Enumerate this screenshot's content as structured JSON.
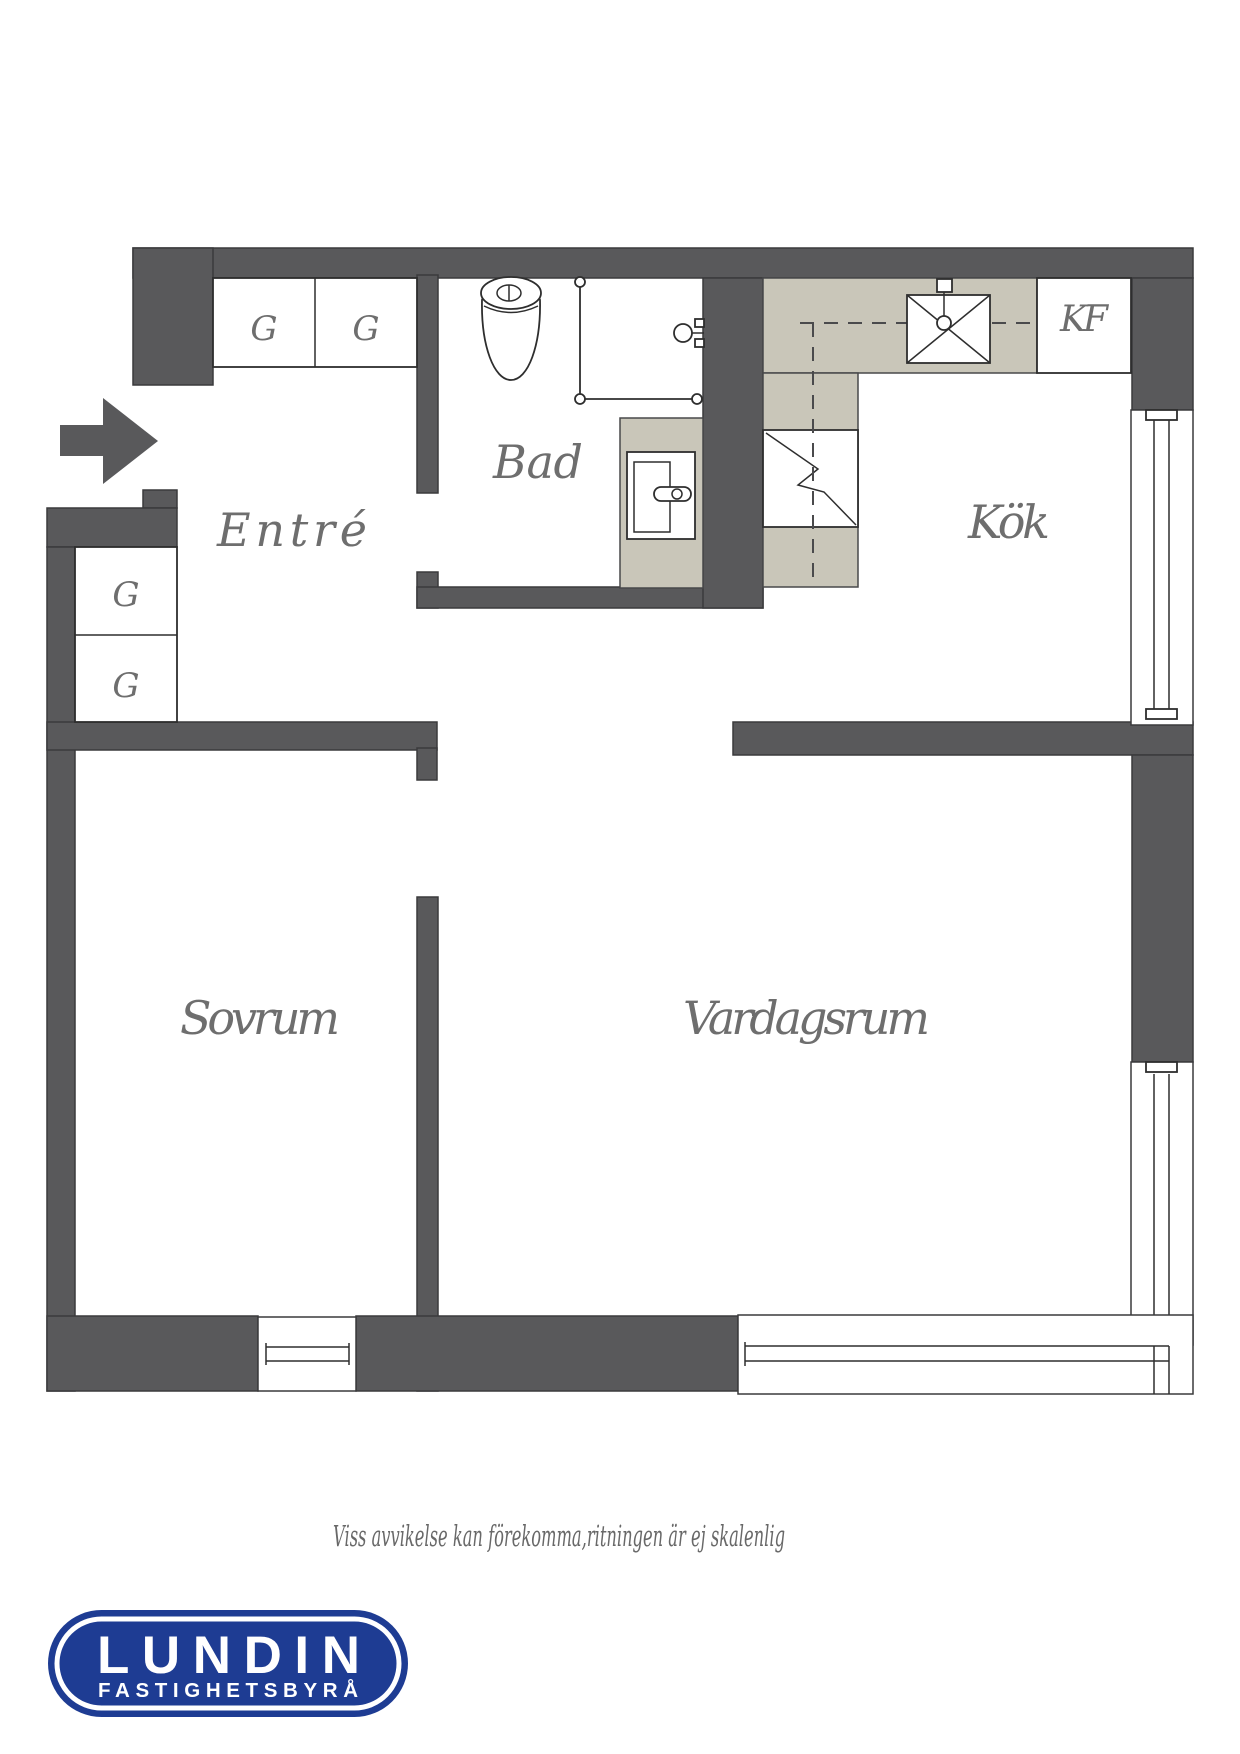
{
  "colors": {
    "background": "#ffffff",
    "wall": "#59595b",
    "wall-outline": "#3a3a3c",
    "counter": "#c9c6b9",
    "line": "#2e2e2e",
    "label": "#6e6e6e",
    "logo-blue": "#1e3c93",
    "logo-text": "#ffffff"
  },
  "floorplan": {
    "rooms": [
      {
        "id": "entre",
        "label": "Entré"
      },
      {
        "id": "bad",
        "label": "Bad"
      },
      {
        "id": "kok",
        "label": "Kök"
      },
      {
        "id": "sovrum",
        "label": "Sovrum"
      },
      {
        "id": "vardagsrum",
        "label": "Vardagsrum"
      }
    ],
    "closets": [
      "G",
      "G",
      "G",
      "G"
    ],
    "appliances": {
      "fridge_freezer": "KF"
    }
  },
  "disclaimer": "Viss avvikelse kan förekomma,ritningen är ej skalenlig",
  "logo": {
    "name": "LUNDIN",
    "tagline": "FASTIGHETSBYRÅ"
  }
}
